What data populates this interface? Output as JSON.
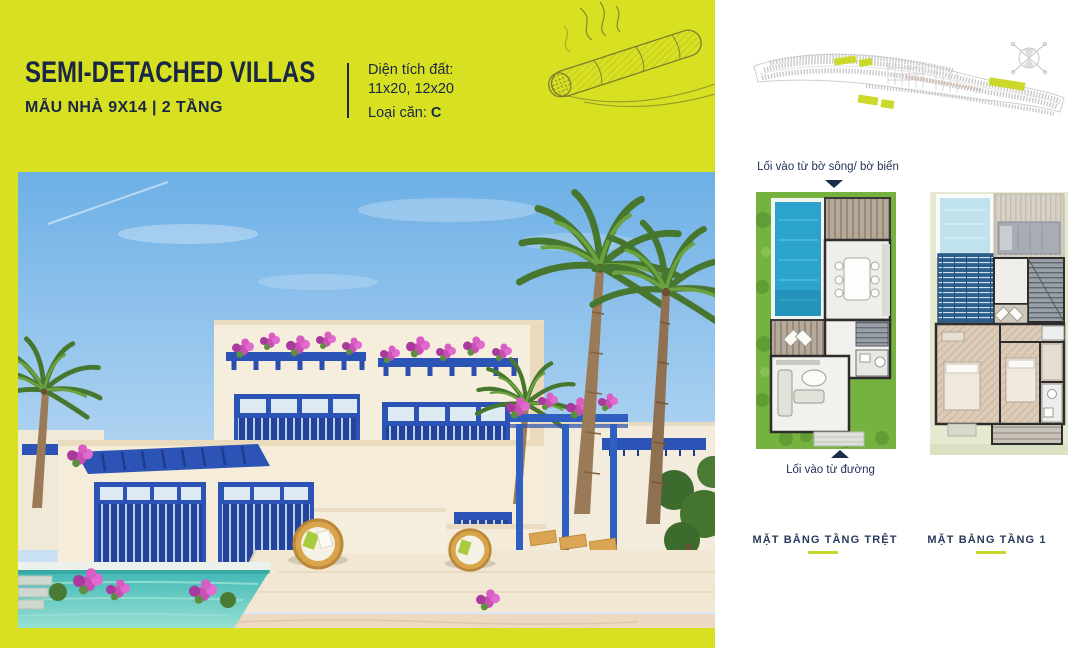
{
  "palette": {
    "accent_yellow": "#d8e022",
    "navy": "#1b2b4e",
    "panel_white": "#ffffff",
    "villa_blue": "#2c53b6",
    "pool_teal": "#4fc4bc",
    "plan_grass_green": "#76b23f",
    "plan_pool_blue": "#2ba3cd",
    "plan_louvre_blue": "#2e6190",
    "plan_bg_sage": "#e4e9cf",
    "caption_underline": "#c9d62d"
  },
  "header": {
    "title": "SEMI-DETACHED VILLAS",
    "subtitle": "MẪU NHÀ 9X14 | 2 TẦNG",
    "land_area_label": "Diện tích đất:",
    "land_area_value": "11x20, 12x20",
    "unit_type_label": "Loại căn:",
    "unit_type_value": "C"
  },
  "floor_plans": {
    "entry_top_label": "Lối vào từ bờ sông/ bờ biển",
    "entry_bottom_label": "Lối vào từ đường",
    "ground_floor_caption": "MẶT BẰNG TẦNG TRỆT",
    "first_floor_caption": "MẶT BẰNG TẦNG 1"
  },
  "icons": {
    "compass": "compass-rose-icon",
    "cigar": "cigar-sketch-illustration",
    "entry_arrow_down": "triangle-down-arrow",
    "entry_arrow_up": "triangle-up-arrow"
  },
  "images": {
    "villa_rendering": "semi-detached-villa-exterior-rendering",
    "site_plan": "master-site-plan-map",
    "ground_floor_plan": "ground-floor-plan",
    "first_floor_plan": "first-floor-plan"
  }
}
